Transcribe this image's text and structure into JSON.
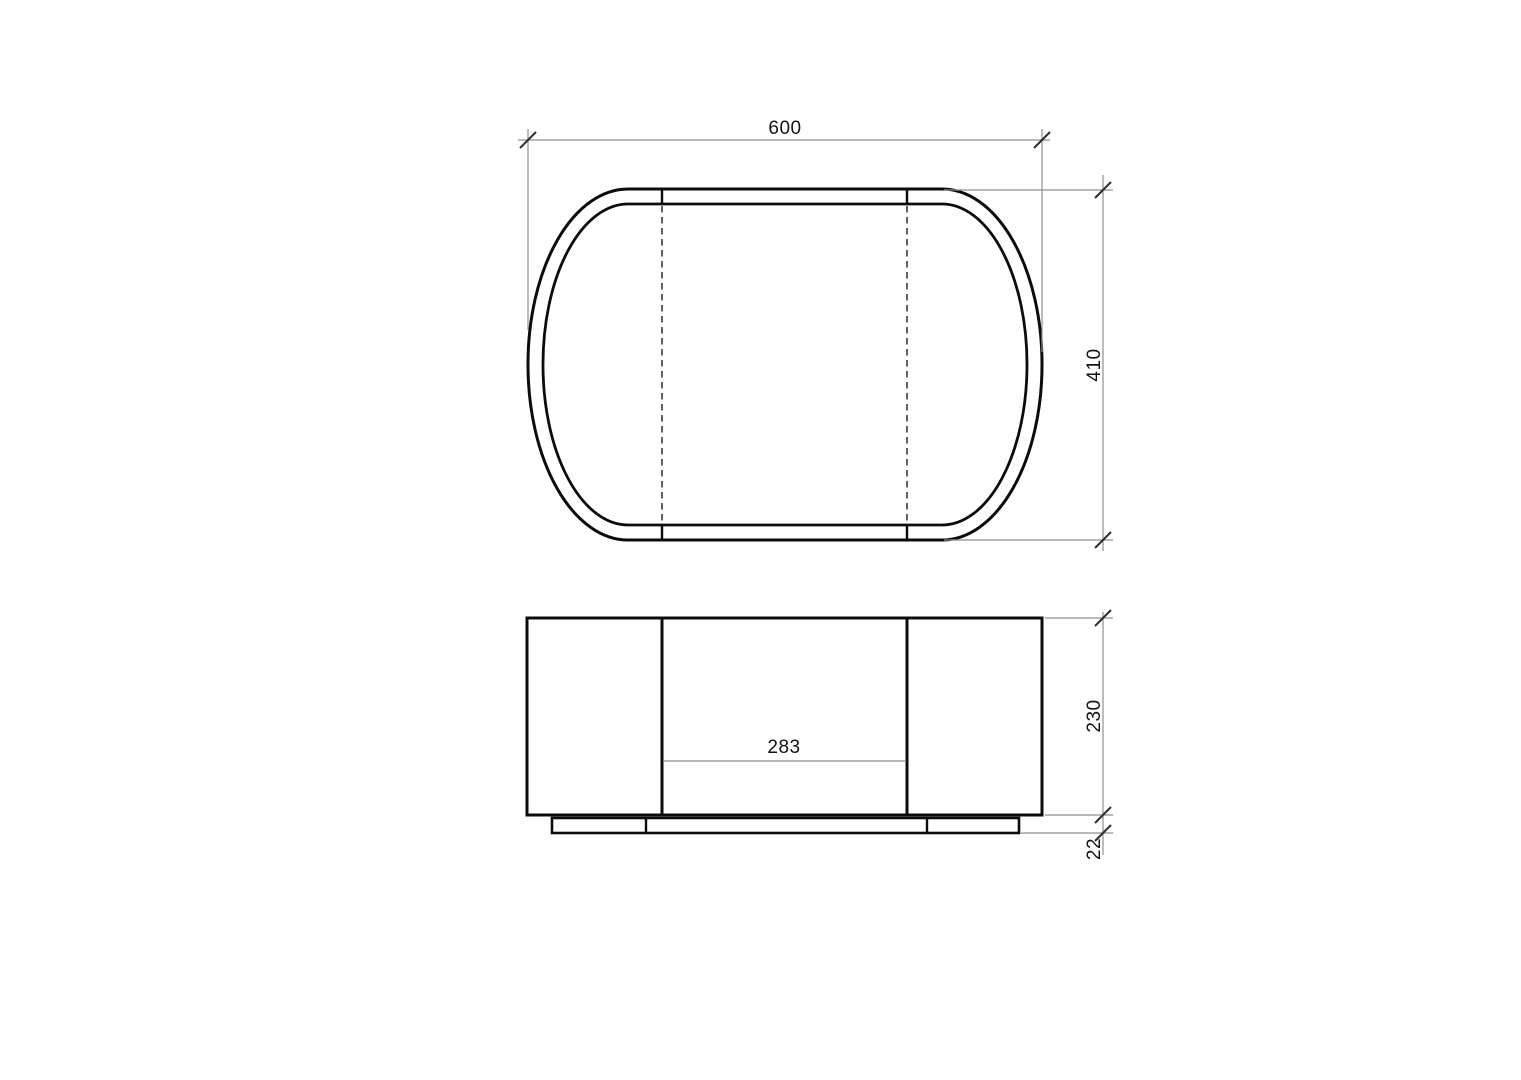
{
  "drawing": {
    "dimensions": {
      "top_width": "600",
      "top_depth": "410",
      "front_opening_width": "283",
      "front_body_height": "230",
      "front_plinth_height": "22"
    },
    "colors": {
      "background": "#ffffff",
      "outline": "#0c0c0c",
      "hidden_line": "#1e1e1e",
      "dimension_line": "#8f8f8f",
      "tick": "#2f2f2f",
      "text": "#141414"
    }
  }
}
